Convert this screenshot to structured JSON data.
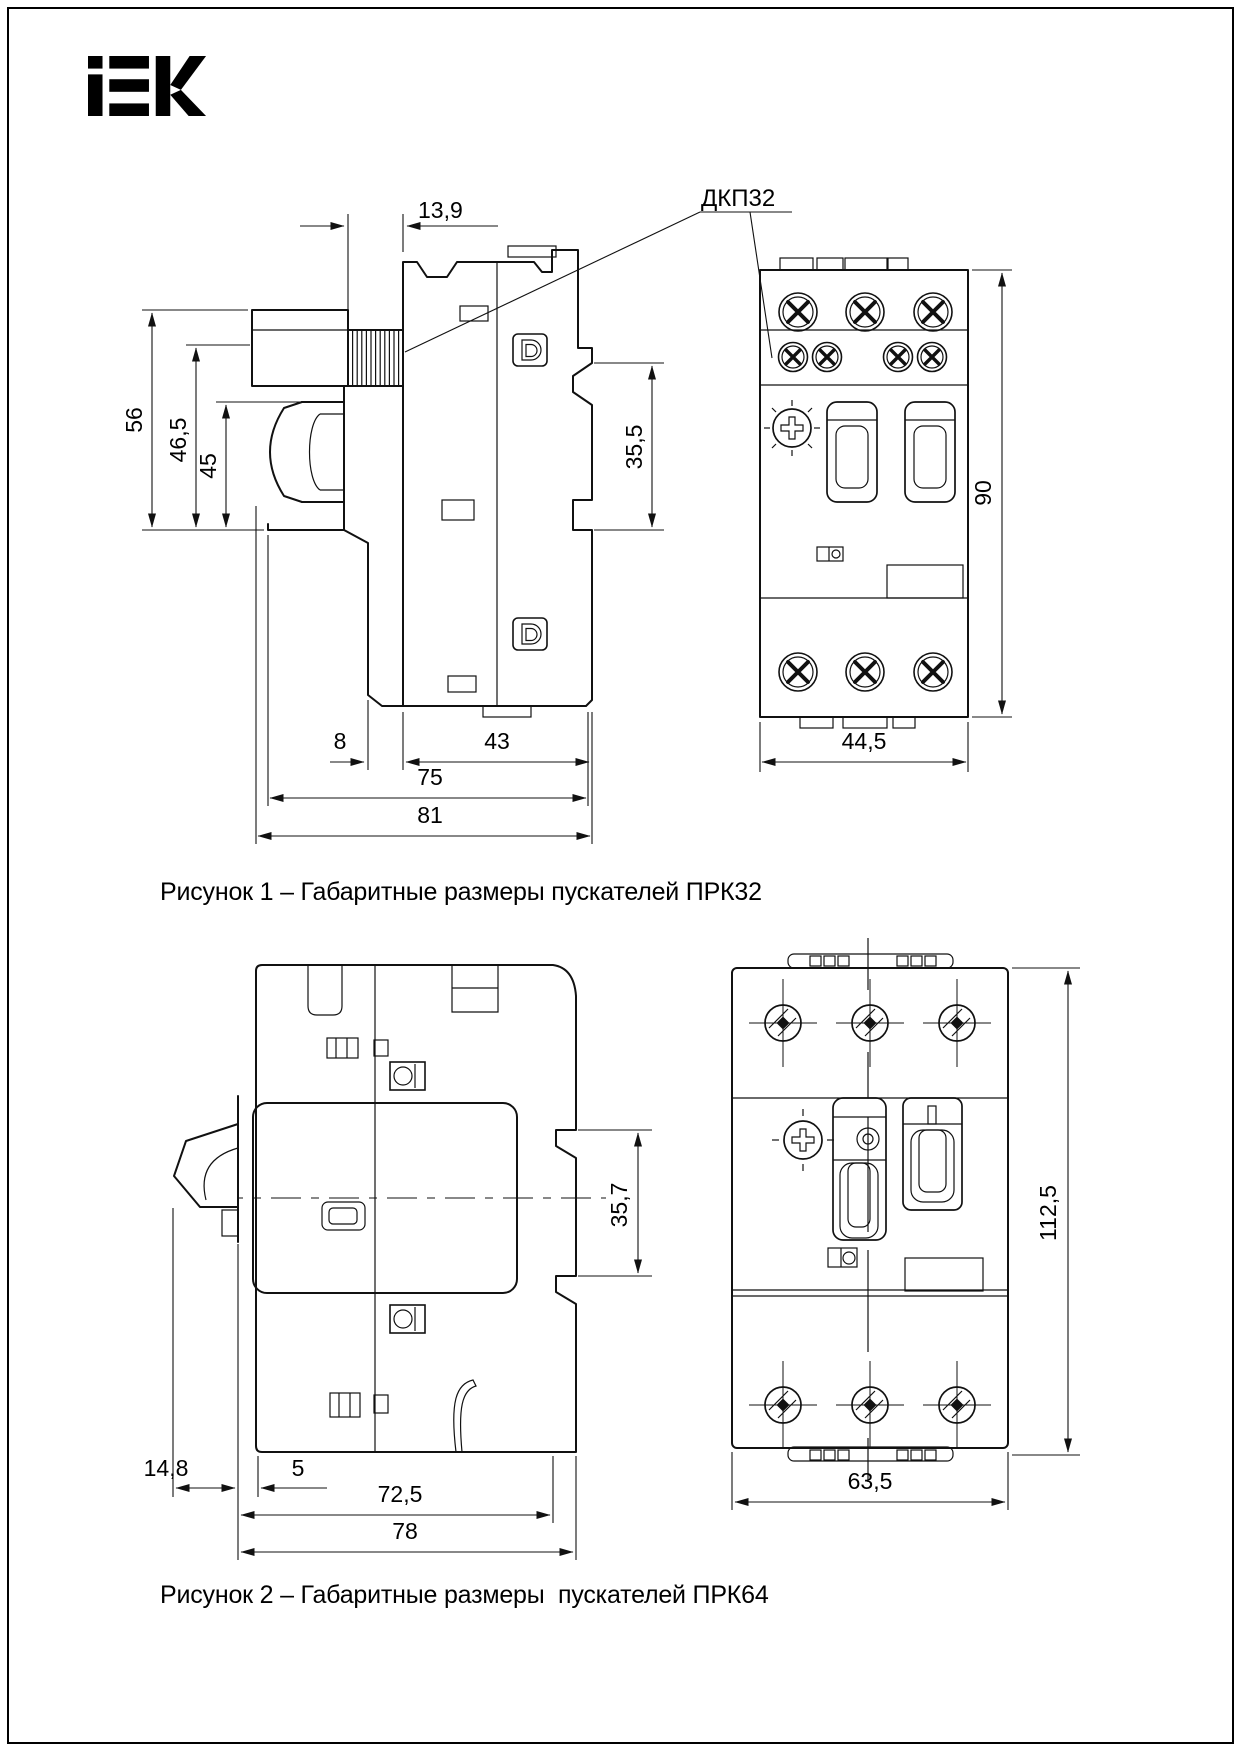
{
  "brand": {
    "name": "IEK"
  },
  "figure1": {
    "caption": "Рисунок 1 – Габаритные размеры пускателей ПРК32",
    "callout_label": "ДКП32",
    "dimensions": {
      "terminal_width": "13,9",
      "height_total": "56",
      "height_to_lip": "46,5",
      "height_knob": "45",
      "din_recess_height": "35,5",
      "front_step_depth": "8",
      "rear_depth": "43",
      "depth_without_knob": "75",
      "depth_total": "81",
      "front_height": "90",
      "front_width": "44,5"
    }
  },
  "figure2": {
    "caption": "Рисунок 2 – Габаритные размеры  пускателей ПРК64",
    "dimensions": {
      "lever_depth": "14,8",
      "panel_gap": "5",
      "depth_body": "72,5",
      "depth_total": "78",
      "din_recess_height": "35,7",
      "front_height": "112,5",
      "front_width": "63,5"
    }
  }
}
